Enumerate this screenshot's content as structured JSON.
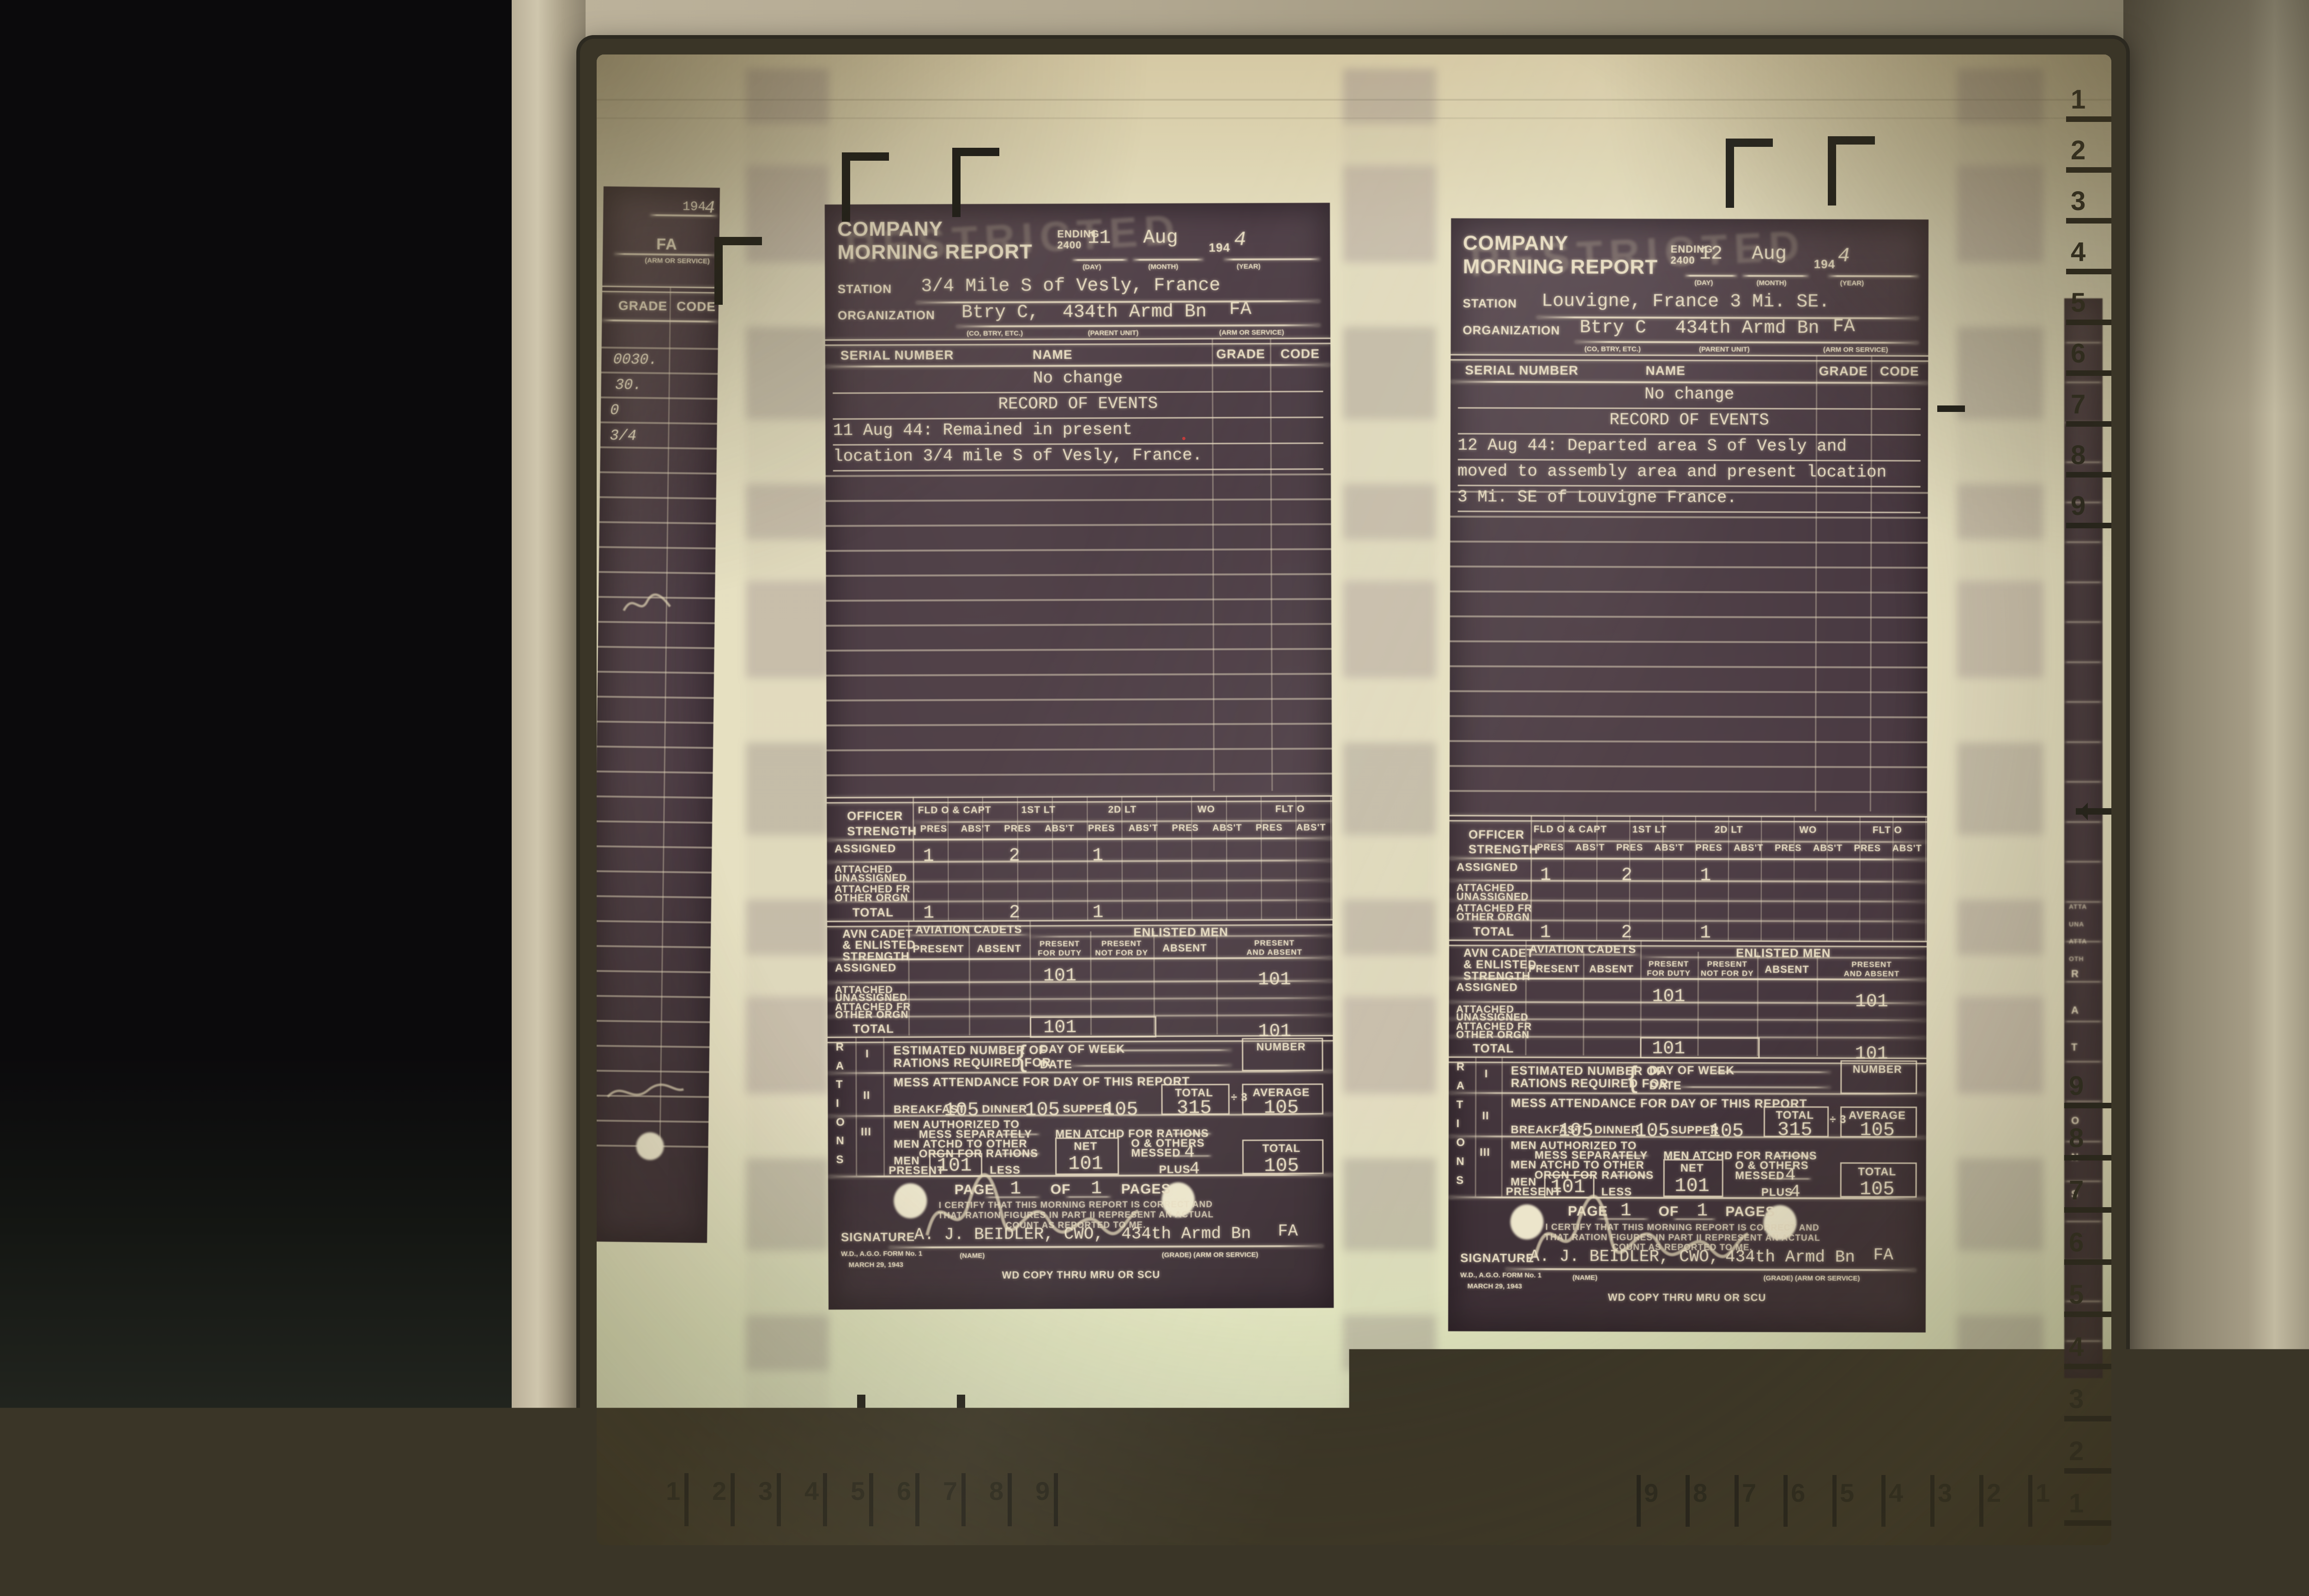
{
  "machine": {
    "roll_button_label": "Roll"
  },
  "screen": {
    "format_markers": {
      "legal": "LGL",
      "letter": "LTR"
    },
    "center_marker_icon": "center-alignment-marker",
    "rulers": {
      "bottom_left_numbers": [
        "1",
        "2",
        "3",
        "4",
        "5",
        "6",
        "7",
        "8",
        "9"
      ],
      "bottom_right_numbers": [
        "9",
        "8",
        "7",
        "6",
        "5",
        "4",
        "3",
        "2",
        "1"
      ],
      "right_top_numbers": [
        "1",
        "2",
        "3",
        "4",
        "5",
        "6",
        "7",
        "8",
        "9"
      ],
      "right_bottom_numbers": [
        "9",
        "8",
        "7",
        "6",
        "5",
        "4",
        "3",
        "2",
        "1"
      ]
    }
  },
  "form": {
    "stamp": "RESTRICTED",
    "title_line1": "COMPANY",
    "title_line2": "MORNING REPORT",
    "ending_label": "ENDING",
    "ending_2400": "2400",
    "day_sub": "(DAY)",
    "month_sub": "(MONTH)",
    "year_sub": "(YEAR)",
    "year_prefix": "194",
    "station_label": "STATION",
    "organization_label": "ORGANIZATION",
    "org_sub1": "(CO, BTRY, ETC.)",
    "org_sub2": "(PARENT UNIT)",
    "org_sub3": "(ARM OR SERVICE)",
    "roster_headers": {
      "serial": "SERIAL NUMBER",
      "name": "NAME",
      "grade": "GRADE",
      "code": "CODE"
    },
    "officer": {
      "row_label_1": "OFFICER",
      "row_label_2": "STRENGTH",
      "groups": [
        "FLD O & CAPT",
        "1ST LT",
        "2D LT",
        "WO",
        "FLT O"
      ],
      "pres": "PRES",
      "abst": "ABS'T",
      "rows": {
        "assigned": "ASSIGNED",
        "attached_1": "ATTACHED",
        "attached_2": "UNASSIGNED",
        "attached_fr_1": "ATTACHED FR",
        "attached_fr_2": "OTHER ORGN",
        "total": "TOTAL"
      }
    },
    "avn": {
      "row_label_1": "AVN CADET",
      "row_label_2": "& ENLISTED",
      "row_label_3": "STRENGTH",
      "cadets": "AVIATION CADETS",
      "enlisted": "ENLISTED MEN",
      "present": "PRESENT",
      "absent": "ABSENT",
      "pfd_1": "PRESENT",
      "pfd_2": "FOR DUTY",
      "pnfd_1": "PRESENT",
      "pnfd_2": "NOT FOR DY",
      "pa_1": "PRESENT",
      "pa_2": "AND ABSENT"
    },
    "rations": {
      "rail": "RATIONS",
      "roman_1": "I",
      "roman_2": "II",
      "roman_3": "III",
      "est_1": "ESTIMATED NUMBER OF",
      "est_2": "RATIONS REQUIRED FOR",
      "day_of_week": "DAY OF WEEK",
      "date": "DATE",
      "number": "NUMBER",
      "mess_attendance": "MESS ATTENDANCE FOR DAY OF THIS REPORT",
      "breakfast": "BREAKFAST",
      "dinner": "DINNER",
      "supper": "SUPPER",
      "total": "TOTAL",
      "divide": "÷ 3",
      "average": "AVERAGE",
      "auth_1": "MEN AUTHORIZED TO",
      "auth_2": "MESS SEPARATELY",
      "atchd_for": "MEN ATCHD FOR RATIONS",
      "atchd_other_1": "MEN ATCHD TO OTHER",
      "atchd_other_2": "ORGN FOR RATIONS",
      "net": "NET",
      "o_others_1": "O & OTHERS",
      "o_others_2": "MESSED",
      "men_1": "MEN",
      "men_2": "PRESENT",
      "less": "LESS",
      "plus": "PLUS"
    },
    "page_label": "PAGE",
    "of_label": "OF",
    "pages_label": "PAGES",
    "certify_1": "I CERTIFY THAT THIS MORNING REPORT IS CORRECT AND",
    "certify_2": "THAT RATION FIGURES IN PART II REPRESENT AN ACTUAL",
    "certify_3": "COUNT AS REPORTED TO ME.",
    "signature_label": "SIGNATURE",
    "name_sub": "(NAME)",
    "grade_arm_sub": "(GRADE)  (ARM OR SERVICE)",
    "form_no": "W.D., A.G.O. FORM No. 1",
    "form_date": "MARCH 29, 1943",
    "wd_copy": "WD COPY THRU MRU OR SCU"
  },
  "docs": [
    {
      "day": "11",
      "month": "Aug",
      "year_digit": "4",
      "station": "3/4 Mile S of Vesly, France",
      "org_unit": "Btry C,",
      "org_parent": "434th Armd Bn",
      "org_arm": "FA",
      "events": [
        "No change",
        "RECORD OF EVENTS",
        "11 Aug 44: Remained in present",
        "location 3/4 mile S of Vesly, France."
      ],
      "officer_assigned": [
        "1",
        "2",
        "1"
      ],
      "officer_total": [
        "1",
        "2",
        "1"
      ],
      "enlisted": {
        "assigned_pfd": "101",
        "assigned_pa": "101",
        "total_pfd": "101",
        "total_pa": "101"
      },
      "rations": {
        "breakfast": "105",
        "dinner": "105",
        "supper": "105",
        "mess_total": "315",
        "average": "105",
        "men_present": "101",
        "net": "101",
        "messed": "4",
        "plus": "4",
        "total": "105"
      },
      "page": "1",
      "pages": "1",
      "signature": {
        "typed_name": "A. J. BEIDLER, CWO,",
        "typed_unit": "434th Armd Bn",
        "typed_arm": "FA"
      }
    },
    {
      "day": "12",
      "month": "Aug",
      "year_digit": "4",
      "station": "Louvigne, France 3 Mi. SE.",
      "org_unit": "Btry C",
      "org_parent": "434th Armd Bn",
      "org_arm": "FA",
      "events": [
        "No change",
        "RECORD OF EVENTS",
        "12 Aug 44:  Departed area S of Vesly and",
        "moved to assembly area and present location",
        "3 Mi. SE of Louvigne France."
      ],
      "officer_assigned": [
        "1",
        "2",
        "1"
      ],
      "officer_total": [
        "1",
        "2",
        "1"
      ],
      "enlisted": {
        "assigned_pfd": "101",
        "assigned_pa": "101",
        "total_pfd": "101",
        "total_pa": "101"
      },
      "rations": {
        "breakfast": "105",
        "dinner": "105",
        "supper": "105",
        "mess_total": "315",
        "average": "105",
        "men_present": "101",
        "net": "101",
        "messed": "4",
        "plus": "4",
        "total": "105"
      },
      "page": "1",
      "pages": "1",
      "signature": {
        "typed_name": "A. J. BEIDLER, CWO,",
        "typed_unit": "434th Armd Bn",
        "typed_arm": "FA"
      }
    }
  ],
  "left_partial_doc": {
    "year_prefix": "194",
    "year_digit": "4",
    "arm": "FA",
    "arm_sub": "(ARM OR SERVICE)",
    "grade": "GRADE",
    "code": "CODE",
    "entries": [
      "0030.",
      "30.",
      "0",
      "3/4"
    ]
  },
  "right_partial_doc": {
    "rail_letters": [
      "R",
      "A",
      "T",
      "I",
      "O",
      "N",
      "S"
    ],
    "fragments": [
      "ATTA",
      "UNA",
      "ATTA",
      "OTH"
    ]
  }
}
